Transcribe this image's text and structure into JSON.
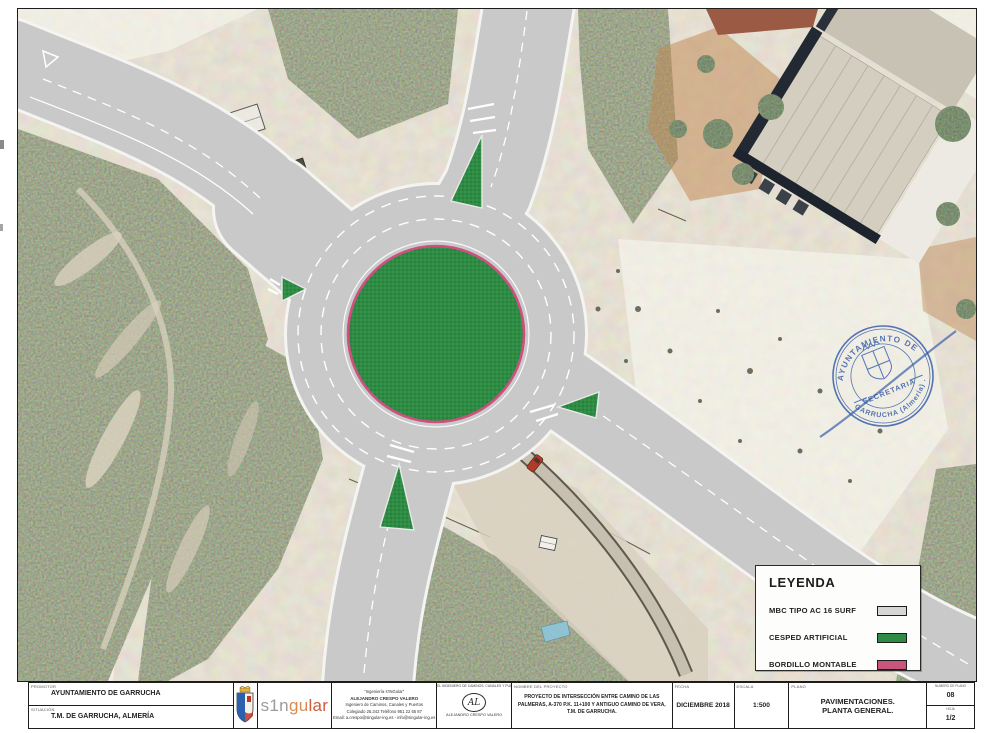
{
  "sheet": {
    "palette": {
      "asphalt": "#c9c9c9",
      "turf_green": "#2f8c45",
      "kerb_pink": "#cf4f80",
      "stamp_blue": "#2d55a8"
    },
    "legend": {
      "title": "LEYENDA",
      "items": [
        {
          "label": "MBC TIPO AC 16 SURF",
          "color": "#d6d6d4"
        },
        {
          "label": "CESPED ARTIFICIAL",
          "color": "#2f8c45"
        },
        {
          "label": "BORDILLO MONTABLE",
          "color": "#c9547c"
        }
      ]
    },
    "stamp": {
      "arc_top": "AYUNTAMIENTO DE",
      "arc_bottom": "GARRUCHA (Almería) .",
      "center": "SECRETARIA"
    },
    "title_block": {
      "promotor_label": "PROMOTOR",
      "promotor": "AYUNTAMIENTO DE GARRUCHA",
      "situacion_label": "SITUACIÓN",
      "situacion": "T.M. DE GARRUCHA, ALMERÍA",
      "logo_part1": "s1n",
      "logo_part2": "gu",
      "logo_part3": "lar",
      "engineer": {
        "l1": "\"Ingeniería s'INGular\"",
        "l2": "ALEJANDRO CRESPO VALERO",
        "l3": "Ingeniero de Caminos, Canales y Puertos",
        "l4": "Colegiado 25.342   Teléfono 951 22 65 87",
        "l5": "Email: a.crespo@singular-ing.es - info@singular-ing.es"
      },
      "signature": {
        "header": "EL INGENIERO DE CAMINOS, CANALES Y PUERTOS",
        "monogram": "AL",
        "name": "ALEJANDRO CRESPO VALERO"
      },
      "project_label": "NOMBRE DEL PROYECTO",
      "project_line1": "PROYECTO DE INTERSECCIÓN ENTRE CAMINO DE LAS",
      "project_line2": "PALMERAS, A-370 P.K. 11+100 Y ANTIGUO CAMINO DE VERA,",
      "project_line3": "T.M. DE GARRUCHA.",
      "fecha_label": "FECHA",
      "fecha": "DICIEMBRE 2018",
      "escala_label": "ESCALA",
      "escala": "1:500",
      "plano_label": "PLANO",
      "plano_line1": "PAVIMENTACIONES.",
      "plano_line2": "PLANTA GENERAL.",
      "num_plano_label": "NUMERO DE PLANO",
      "num_plano": "08",
      "hoja_label": "HOJA",
      "hoja": "1/2"
    }
  }
}
